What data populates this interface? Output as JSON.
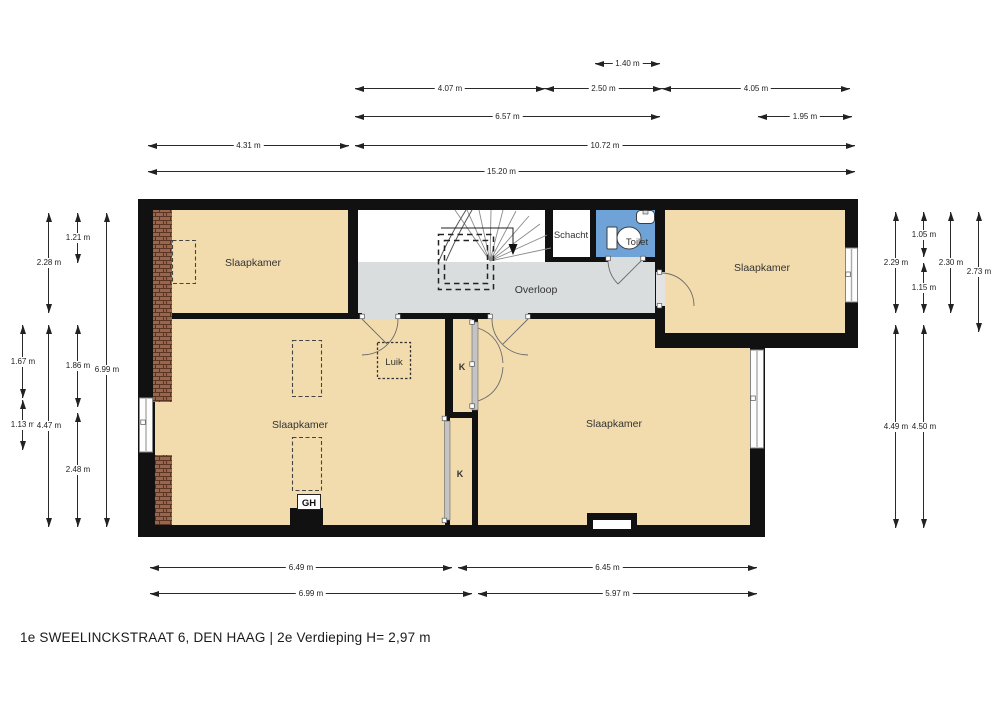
{
  "caption": "1e SWEELINCKSTRAAT 6, DEN HAAG | 2e Verdieping H= 2,97 m",
  "rooms": {
    "bedroom_top_left": "Slaapkamer",
    "bedroom_top_right": "Slaapkamer",
    "bedroom_bottom_left": "Slaapkamer",
    "bedroom_bottom_right": "Slaapkamer",
    "landing": "Overloop",
    "shaft": "Schacht",
    "toilet": "Toilet",
    "hatch": "Luik",
    "closet_upper": "K",
    "closet_lower": "K",
    "water_heater": "GH"
  },
  "colors": {
    "room_fill": "#f2dcae",
    "landing_fill": "#d9dddd",
    "toilet_fill": "#6fa3d7",
    "wall": "#111111",
    "brick": "#99664d",
    "window": "#fdfdfd",
    "dimension_text": "#222222"
  },
  "dimensions": {
    "horizontal": [
      {
        "label": "1.40 m",
        "x": 595,
        "y": 63,
        "len": 65
      },
      {
        "label": "4.07 m",
        "x": 355,
        "y": 88,
        "len": 190
      },
      {
        "label": "2.50 m",
        "x": 545,
        "y": 88,
        "len": 117
      },
      {
        "label": "4.05 m",
        "x": 662,
        "y": 88,
        "len": 188
      },
      {
        "label": "6.57 m",
        "x": 355,
        "y": 116,
        "len": 305
      },
      {
        "label": "1.95 m",
        "x": 758,
        "y": 116,
        "len": 94
      },
      {
        "label": "4.31 m",
        "x": 148,
        "y": 145,
        "len": 201
      },
      {
        "label": "10.72 m",
        "x": 355,
        "y": 145,
        "len": 500
      },
      {
        "label": "15.20 m",
        "x": 148,
        "y": 171,
        "len": 707
      },
      {
        "label": "6.49 m",
        "x": 150,
        "y": 567,
        "len": 302
      },
      {
        "label": "6.45 m",
        "x": 458,
        "y": 567,
        "len": 299
      },
      {
        "label": "6.99 m",
        "x": 150,
        "y": 593,
        "len": 322
      },
      {
        "label": "5.97 m",
        "x": 478,
        "y": 593,
        "len": 279
      }
    ],
    "vertical": [
      {
        "label": "1.67 m",
        "x": 22,
        "y": 325,
        "len": 73
      },
      {
        "label": "1.13 m",
        "x": 22,
        "y": 400,
        "len": 50
      },
      {
        "label": "2.28 m",
        "x": 48,
        "y": 213,
        "len": 100
      },
      {
        "label": "4.47 m",
        "x": 48,
        "y": 325,
        "len": 202
      },
      {
        "label": "1.21 m",
        "x": 77,
        "y": 213,
        "len": 50
      },
      {
        "label": "1.86 m",
        "x": 77,
        "y": 325,
        "len": 82
      },
      {
        "label": "2.48 m",
        "x": 77,
        "y": 413,
        "len": 114
      },
      {
        "label": "6.99 m",
        "x": 106,
        "y": 213,
        "len": 314
      },
      {
        "label": "2.29 m",
        "x": 895,
        "y": 212,
        "len": 101
      },
      {
        "label": "4.49 m",
        "x": 895,
        "y": 325,
        "len": 203
      },
      {
        "label": "1.05 m",
        "x": 923,
        "y": 212,
        "len": 45
      },
      {
        "label": "1.15 m",
        "x": 923,
        "y": 263,
        "len": 50
      },
      {
        "label": "4.50 m",
        "x": 923,
        "y": 325,
        "len": 203
      },
      {
        "label": "2.30 m",
        "x": 950,
        "y": 212,
        "len": 101
      },
      {
        "label": "2.73 m",
        "x": 978,
        "y": 212,
        "len": 120
      }
    ]
  }
}
